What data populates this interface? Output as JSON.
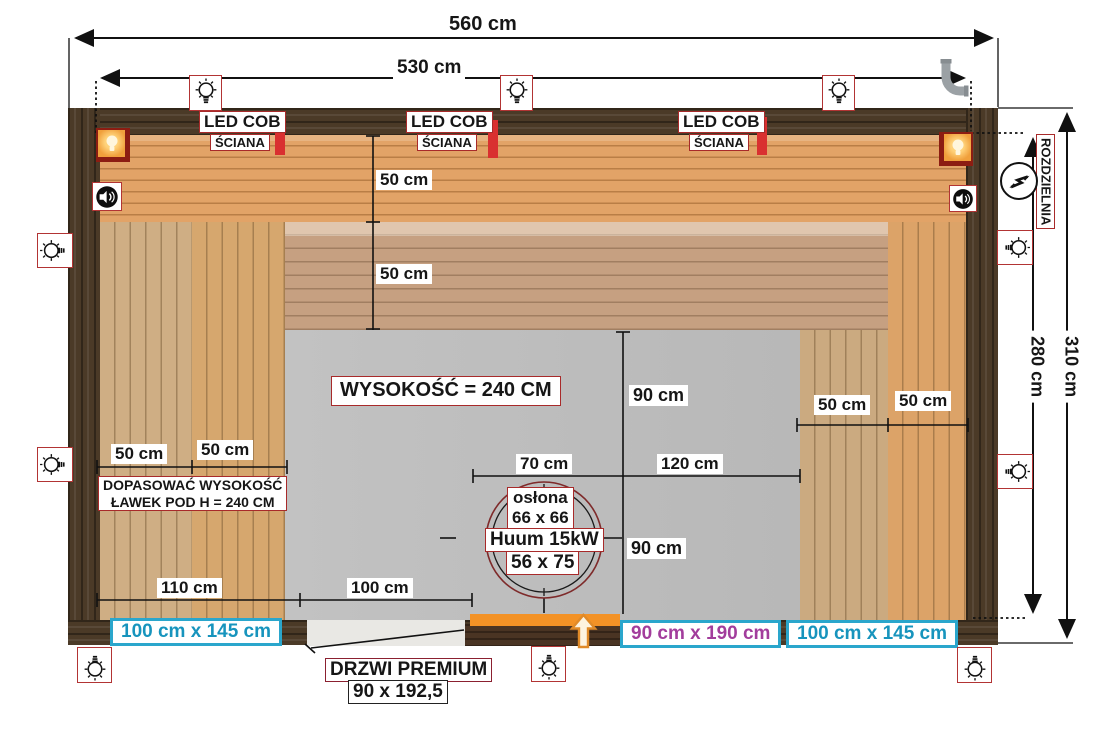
{
  "dimensions": {
    "outer_width": "560 cm",
    "inner_width": "530 cm",
    "outer_height": "310 cm",
    "inner_height": "280 cm",
    "bench_depth": "50 cm",
    "heater_offset_left": "70 cm",
    "heater_offset_right": "120 cm",
    "heater_offset_top": "90 cm",
    "heater_offset_bottom": "90 cm",
    "bottom_left_offset": "110 cm",
    "bottom_mid_offset": "100 cm"
  },
  "annotations": {
    "led_cob": "LED COB",
    "sciana": "ŚCIANA",
    "height_note": "WYSOKOŚĆ = 240 CM",
    "bench_note_line1": "DOPASOWAĆ WYSOKOŚĆ",
    "bench_note_line2": "ŁAWEK POD H = 240 CM",
    "rozdzielnia": "ROZDZIELNIA",
    "door_name": "DRZWI PREMIUM",
    "door_size": "90 x 192,5",
    "window_left": "100 cm x 145 cm",
    "glass_panel": "90 cm x 190 cm",
    "window_right": "100 cm x 145 cm"
  },
  "heater": {
    "cover_label": "osłona",
    "cover_size": "66 x 66",
    "model": "Huum 15kW",
    "base_size": "56 x 75"
  },
  "icons": {
    "light_point": "light-bulb-icon",
    "corner_lamp": "corner-lamp-icon",
    "speaker": "speaker-icon",
    "electrical_panel": "electrical-panel-icon",
    "vent_pipe": "vent-pipe-icon",
    "entry_arrow": "up-arrow-icon"
  },
  "colors": {
    "dimension_line": "#111111",
    "label_border_red": "#a82a2a",
    "led_strip_red": "#d93030",
    "window_cyan": "#2aa6cc",
    "window_text_cyan": "#1794bd",
    "glass_text_magenta": "#a23d9c",
    "door_orange": "#f39226",
    "corner_lamp_orange": "#f0a03c",
    "wall_dark_wood": "#4b3a27",
    "bench_wood_light": "#e2a367",
    "bench_wood_muted": "#c6a081",
    "floor_gray": "#bcbcbc",
    "pipe_gray": "#9ba1a5"
  }
}
